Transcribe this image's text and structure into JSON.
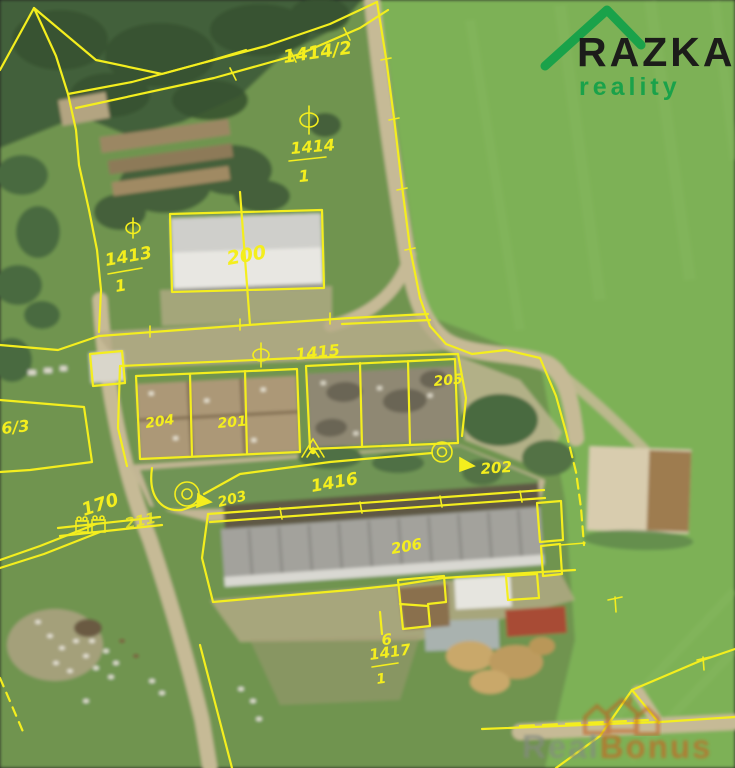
{
  "map": {
    "description": "aerial cadastral overlay of farm parcels",
    "overlay_color": "#f4ee1e",
    "labels": {
      "p1414_2": "1414/2",
      "p1414_num": "1414",
      "p1414_den": "1",
      "p1413_num": "1413",
      "p1413_den": "1",
      "p200": "200",
      "p1415": "1415",
      "p204": "204",
      "p201": "201",
      "p205": "205",
      "p202": "202",
      "p203": "203",
      "p1416": "1416",
      "p170": "170",
      "p211": "211",
      "p206": "206",
      "p1417_num": "1417",
      "p1417_den": "1",
      "p6_3": "6/3",
      "land_use_6": "6"
    }
  },
  "logo": {
    "brand": "RAZKA",
    "tagline": "reality",
    "brand_color": "#1c1c1a",
    "accent_color": "#1aa24a"
  },
  "watermark": {
    "part1": "Real",
    "part2": "Bonus",
    "accent_color": "#c06a28",
    "muted_color": "#848b80"
  }
}
